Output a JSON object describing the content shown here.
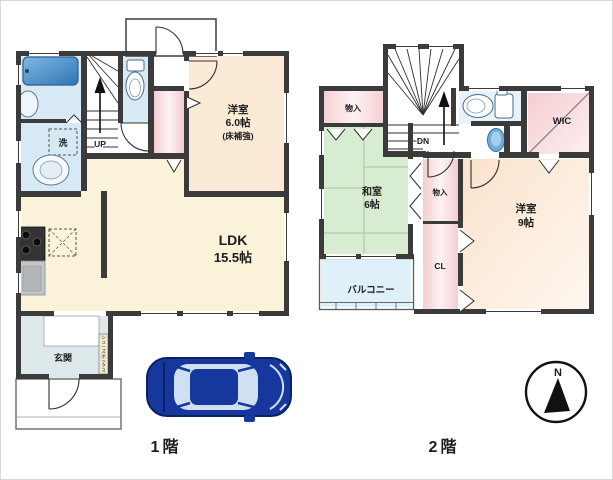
{
  "colors": {
    "wall": "#3b3b3b",
    "cream": "#faf3da",
    "peach1": "#fbead6",
    "peach2": "#fbe3cc",
    "green": "#d8ecd1",
    "pink": "#f5cdd0",
    "blue_room": "#d8e9f6",
    "toilet_room": "#e8f2fa",
    "genkan": "#dde8eb",
    "balcony": "#dff0f9",
    "tub": "#4794d4",
    "fixture_blue": "#6fb0dd",
    "car_body": "#16379e",
    "car_glass": "#cfe0f2",
    "shoebox": "#f2ebd2",
    "counter": "#c2c6c8",
    "stove": "#333333"
  },
  "floor1": {
    "label": "1階",
    "yoshitsu": {
      "name": "洋室",
      "size": "6.0帖",
      "note": "(床補強)"
    },
    "ldk": {
      "name": "LDK",
      "size": "15.5帖"
    },
    "genkan": {
      "name": "玄関"
    },
    "stairs_label": "UP",
    "laundry_label": "洗",
    "shoebox_label": "シューズボックス"
  },
  "floor2": {
    "label": "2階",
    "washitsu": {
      "name": "和室",
      "size": "6帖"
    },
    "yoshitsu": {
      "name": "洋室",
      "size": "9帖"
    },
    "balcony": {
      "name": "バルコニー"
    },
    "storage_top": {
      "name": "物入"
    },
    "storage_mid": {
      "name": "物入"
    },
    "closet": {
      "name": "CL"
    },
    "wic": {
      "name": "WIC"
    },
    "stairs_label": "DN"
  },
  "compass": {
    "north_label": "N"
  }
}
